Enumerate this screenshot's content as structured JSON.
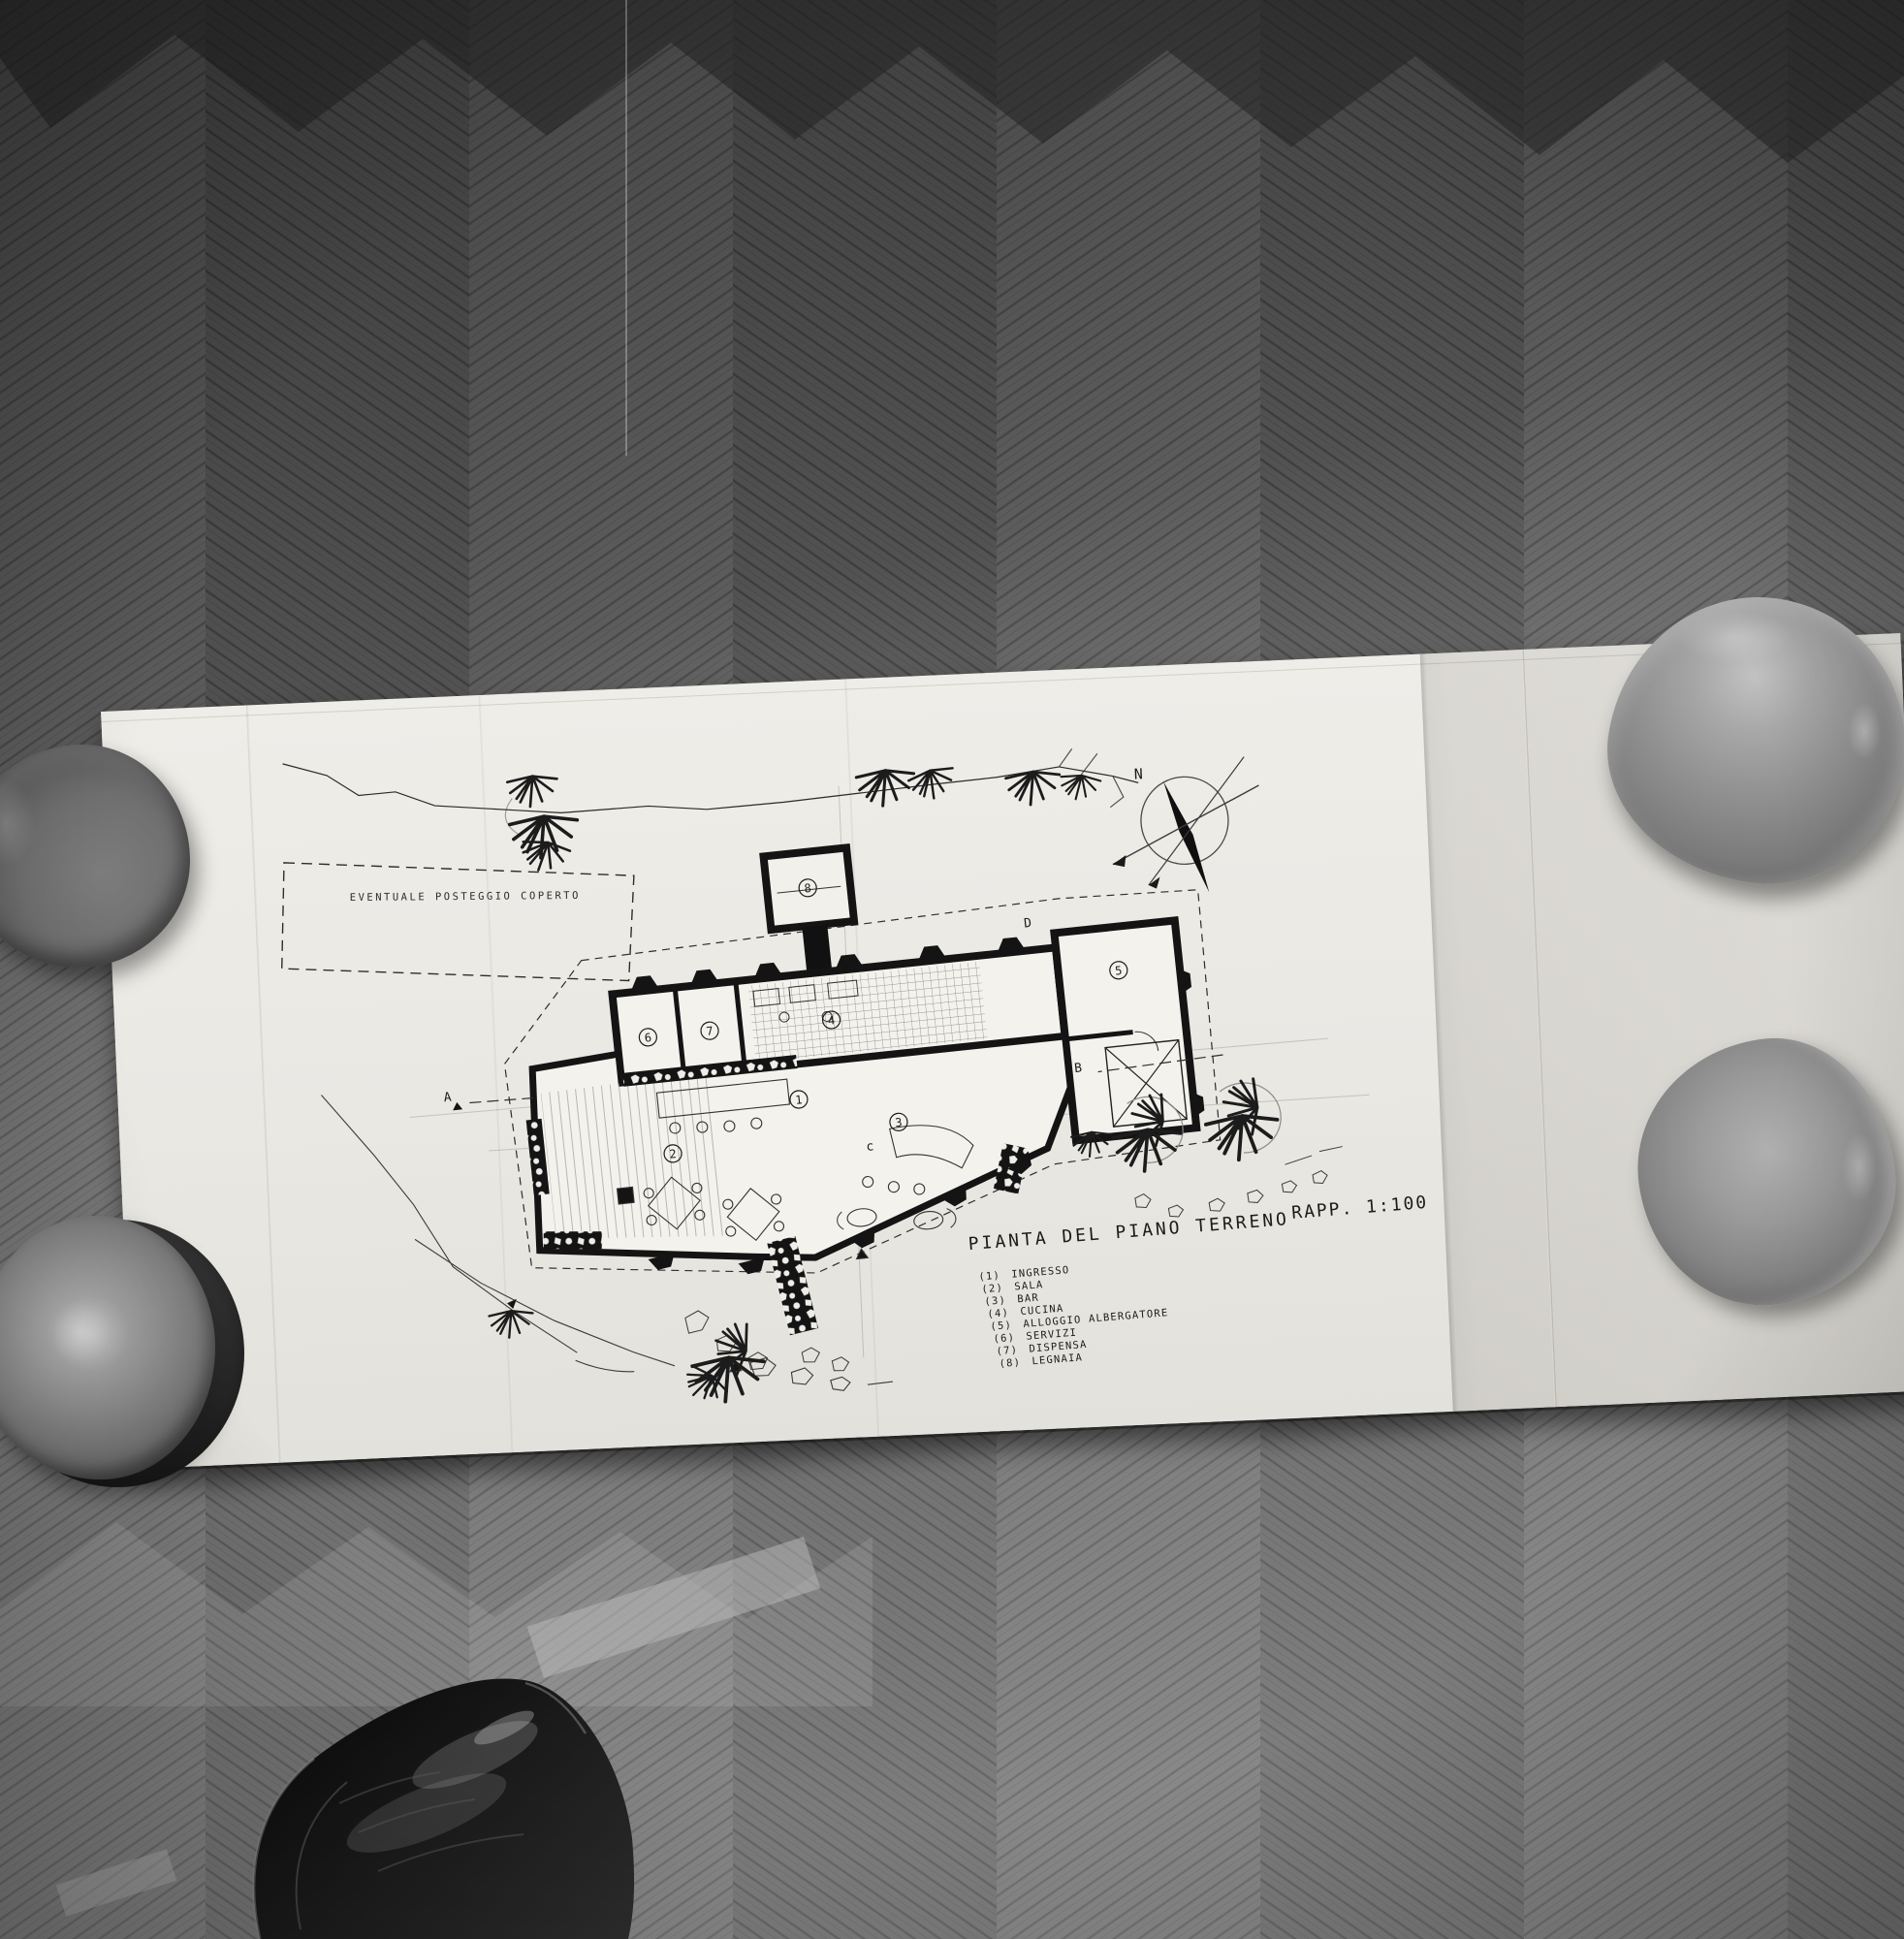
{
  "colors": {
    "paper": "#eae8e3",
    "paper_fold_shade": "#d8d5cf",
    "ink": "#1b1b1b",
    "pencil": "#6a6a6a",
    "floor_dark": "#474747",
    "floor_mid": "#696969",
    "floor_light": "#9a9a9a",
    "plate_gray": "#868686",
    "shoe_black": "#141414"
  },
  "drawing": {
    "title": "PIANTA DEL PIANO TERRENO",
    "scale_label": "RAPP. 1:100",
    "parking_note": "EVENTUALE POSTEGGIO COPERTO",
    "compass_north": "N",
    "section_markers": {
      "a": "A",
      "b": "B",
      "c": "c",
      "d": "D"
    },
    "room_numbers": [
      "1",
      "2",
      "3",
      "4",
      "5",
      "6",
      "7",
      "8"
    ],
    "legend": [
      {
        "num": "(1)",
        "label": "INGRESSO"
      },
      {
        "num": "(2)",
        "label": "SALA"
      },
      {
        "num": "(3)",
        "label": "BAR"
      },
      {
        "num": "(4)",
        "label": "CUCINA"
      },
      {
        "num": "(5)",
        "label": "ALLOGGIO ALBERGATORE"
      },
      {
        "num": "(6)",
        "label": "SERVIZI"
      },
      {
        "num": "(7)",
        "label": "DISPENSA"
      },
      {
        "num": "(8)",
        "label": "LEGNAIA"
      }
    ]
  }
}
